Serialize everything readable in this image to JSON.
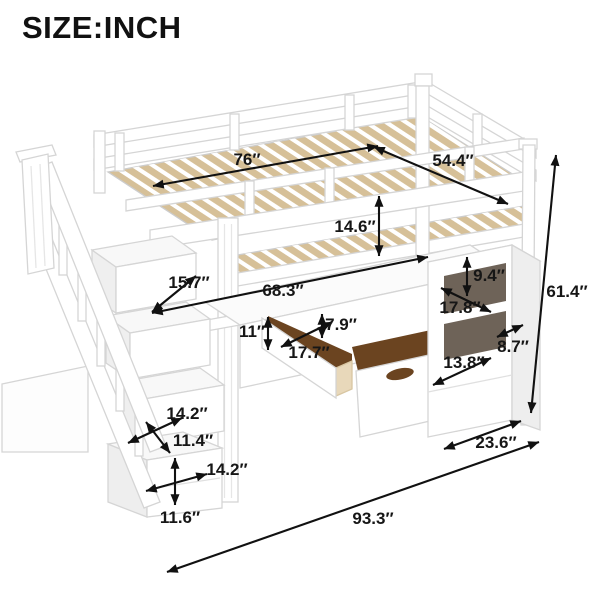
{
  "title": "SIZE:INCH",
  "illustration": {
    "description": "White twin-size loft bed with storage staircase, under-bed shelves and pull-out drawers, annotated with dimensions in inches"
  },
  "colors": {
    "background": "#ffffff",
    "text": "#161616",
    "arrow": "#111111",
    "frame_white": "#ffffff",
    "frame_outline": "#d5d5d5",
    "slat_tan": "#d6c098",
    "drawer_interior": "#6b4420",
    "inner_wood": "#e8d8ba",
    "cubby_shadow": "#6e6358"
  },
  "dimensions": {
    "bed_length": "76″",
    "bed_width": "54.4″",
    "guardrail_height": "14.6″",
    "stair_tread_depth": "15.7″",
    "under_bed_length": "68.3″",
    "drawer_opening_height": "11″",
    "drawer_face_height": "7.9″",
    "left_drawer_width": "17.7″",
    "cubby_height": "9.4″",
    "cubby_width": "17.8″",
    "side_shelf_depth": "8.7″",
    "right_drawer_width": "13.8″",
    "total_height": "61.4″",
    "stair_storage_width": "14.2″",
    "stair_storage_depth": "11.4″",
    "stair_drawer_width": "14.2″",
    "stair_drawer_height": "11.6″",
    "bed_depth": "23.6″",
    "total_length": "93.3″"
  }
}
